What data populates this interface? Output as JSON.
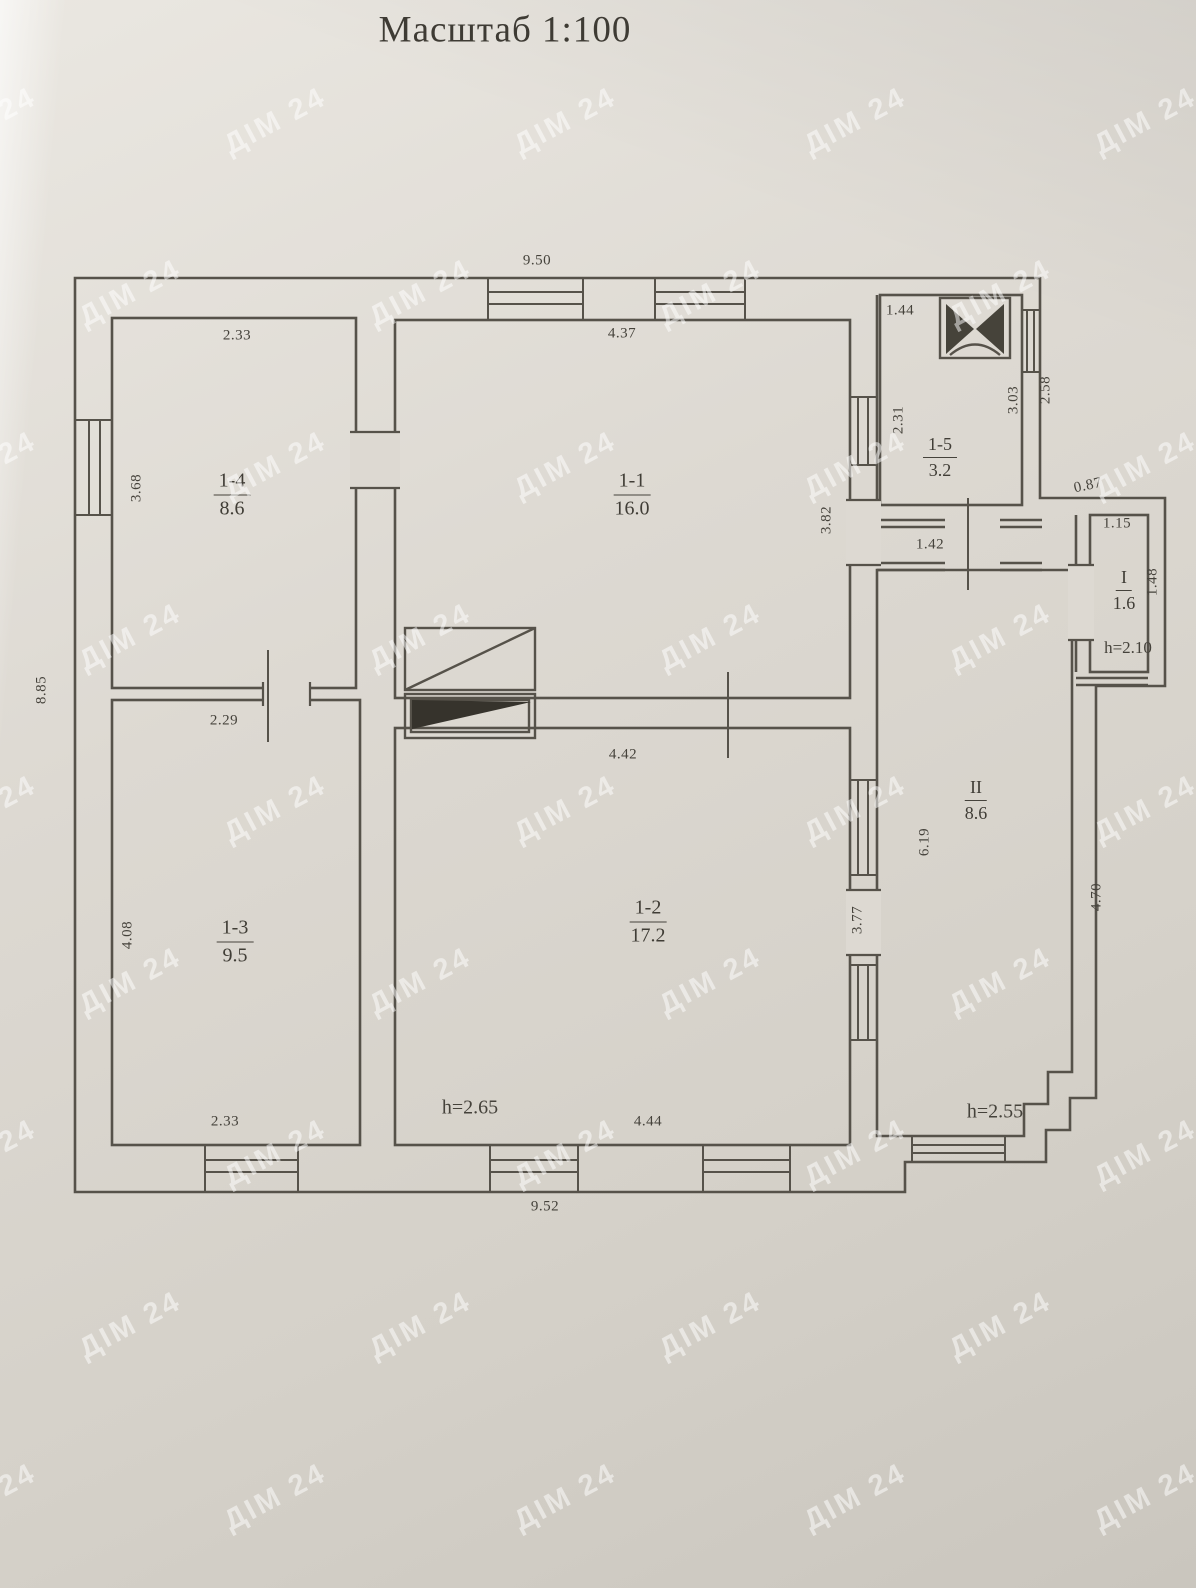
{
  "title": "Масштаб 1:100",
  "watermark": "ДІМ 24",
  "rooms": {
    "r14": {
      "id": "1-4",
      "area": "8.6"
    },
    "r11": {
      "id": "1-1",
      "area": "16.0"
    },
    "r15": {
      "id": "1-5",
      "area": "3.2"
    },
    "r13": {
      "id": "1-3",
      "area": "9.5"
    },
    "r12": {
      "id": "1-2",
      "area": "17.2"
    },
    "rII": {
      "id": "II",
      "area": "8.6"
    },
    "rI": {
      "id": "I",
      "area": "1.6"
    }
  },
  "heights": {
    "r12": "h=2.65",
    "rII": "h=2.55",
    "rI": "h=2.10"
  },
  "dims": {
    "top_width": "9.50",
    "r14_top": "2.33",
    "r11_top": "4.37",
    "r15_top": "1.44",
    "r14_left": "3.68",
    "left_total": "8.85",
    "r15_left": "2.31",
    "r15_right_inner": "3.03",
    "r15_right_outer": "2.58",
    "r11_right": "3.82",
    "hall_width": "1.42",
    "rI_above": "0.87",
    "rI_top": "1.15",
    "rI_right": "1.48",
    "r13_top": "2.29",
    "r12_top": "4.42",
    "r13_left": "4.08",
    "rII_left": "6.19",
    "r12_right": "3.77",
    "rII_right": "4.70",
    "r13_bottom": "2.33",
    "r12_bottom": "4.44",
    "bottom_width": "9.52"
  }
}
